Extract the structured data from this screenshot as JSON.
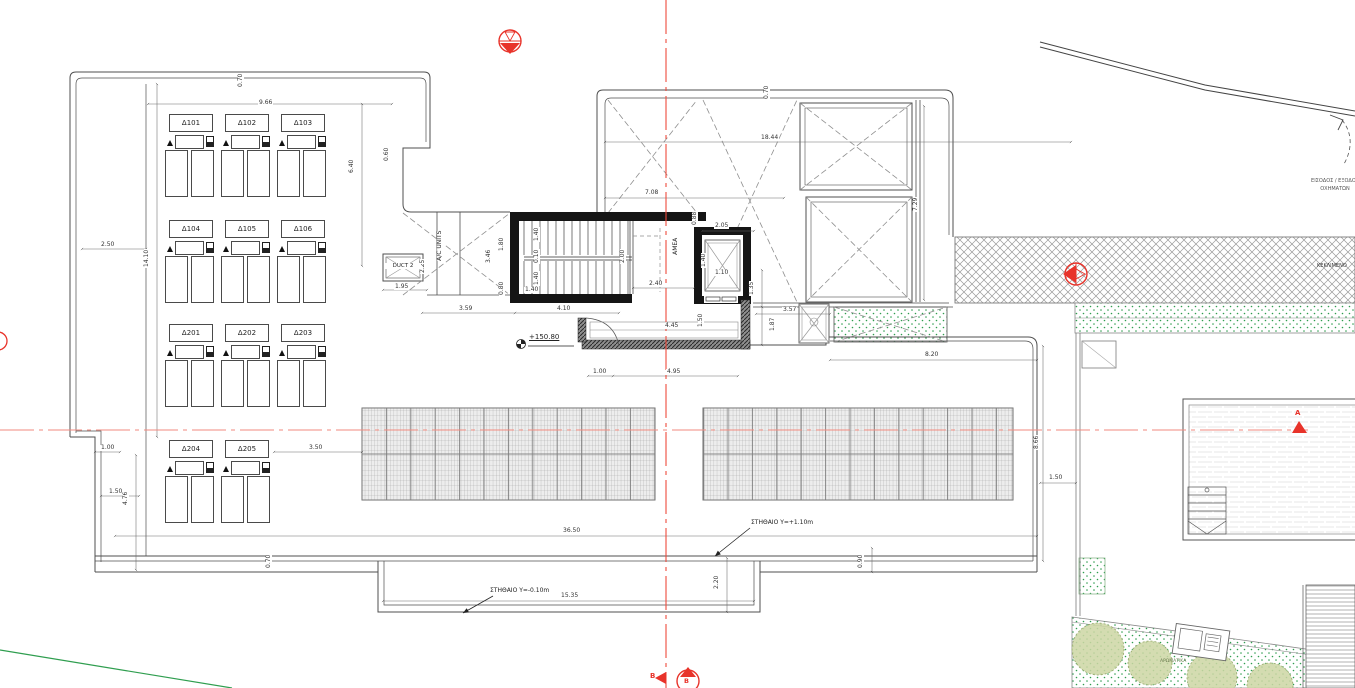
{
  "colors": {
    "line": "#4f4f4f",
    "wall": "#151515",
    "red_marker": "#e8332a",
    "centerline_v": "#ee4b3c",
    "centerline_h": "#f28a7f",
    "green": "#2f9e4f",
    "bush_fill": "#ccd6a3",
    "hatch": "#9a9a9a"
  },
  "ac_units": [
    {
      "label": "Δ101",
      "x": 165,
      "y": 114
    },
    {
      "label": "Δ102",
      "x": 221,
      "y": 114
    },
    {
      "label": "Δ103",
      "x": 277,
      "y": 114
    },
    {
      "label": "Δ104",
      "x": 165,
      "y": 220
    },
    {
      "label": "Δ105",
      "x": 221,
      "y": 220
    },
    {
      "label": "Δ106",
      "x": 277,
      "y": 220
    },
    {
      "label": "Δ201",
      "x": 165,
      "y": 324
    },
    {
      "label": "Δ202",
      "x": 221,
      "y": 324
    },
    {
      "label": "Δ203",
      "x": 277,
      "y": 324
    },
    {
      "label": "Δ204",
      "x": 165,
      "y": 440
    },
    {
      "label": "Δ205",
      "x": 221,
      "y": 440
    }
  ],
  "dimensions": [
    {
      "t": "0.70",
      "x": 244,
      "y": 82,
      "r": 1
    },
    {
      "t": "9.66",
      "x": 258,
      "y": 100
    },
    {
      "t": "2.50",
      "x": 100,
      "y": 242
    },
    {
      "t": "14.10",
      "x": 150,
      "y": 262,
      "r": 1
    },
    {
      "t": "6.40",
      "x": 355,
      "y": 168,
      "r": 1
    },
    {
      "t": "0.60",
      "x": 390,
      "y": 156,
      "r": 1
    },
    {
      "t": "1.00",
      "x": 100,
      "y": 445
    },
    {
      "t": "1.50",
      "x": 108,
      "y": 489
    },
    {
      "t": "4.76",
      "x": 129,
      "y": 500,
      "r": 1
    },
    {
      "t": "3.50",
      "x": 308,
      "y": 445
    },
    {
      "t": "1.95",
      "x": 394,
      "y": 284
    },
    {
      "t": "2.25",
      "x": 426,
      "y": 268,
      "r": 1
    },
    {
      "t": "3.46",
      "x": 492,
      "y": 258,
      "r": 1
    },
    {
      "t": "1.80",
      "x": 505,
      "y": 246,
      "r": 1
    },
    {
      "t": "0.80",
      "x": 505,
      "y": 290,
      "r": 1
    },
    {
      "t": "3.59",
      "x": 458,
      "y": 306
    },
    {
      "t": "4.10",
      "x": 556,
      "y": 306
    },
    {
      "t": "1.40",
      "x": 524,
      "y": 287
    },
    {
      "t": "1.40",
      "x": 540,
      "y": 236,
      "r": 1
    },
    {
      "t": "0.10",
      "x": 540,
      "y": 258,
      "r": 1
    },
    {
      "t": "1.40",
      "x": 540,
      "y": 280,
      "r": 1
    },
    {
      "t": "2.40",
      "x": 648,
      "y": 281
    },
    {
      "t": "2.00",
      "x": 626,
      "y": 258,
      "r": 1
    },
    {
      "t": "0.88",
      "x": 698,
      "y": 220,
      "r": 1
    },
    {
      "t": "2.05",
      "x": 714,
      "y": 223
    },
    {
      "t": "1.40",
      "x": 707,
      "y": 262,
      "r": 1
    },
    {
      "t": "1.10",
      "x": 714,
      "y": 270
    },
    {
      "t": "4.45",
      "x": 664,
      "y": 323
    },
    {
      "t": "1.50",
      "x": 704,
      "y": 322,
      "r": 1
    },
    {
      "t": "1.00",
      "x": 592,
      "y": 369
    },
    {
      "t": "4.95",
      "x": 666,
      "y": 369
    },
    {
      "t": "0.70",
      "x": 770,
      "y": 94,
      "r": 1
    },
    {
      "t": "18.44",
      "x": 760,
      "y": 135
    },
    {
      "t": "7.08",
      "x": 644,
      "y": 190
    },
    {
      "t": "7.29",
      "x": 919,
      "y": 206,
      "r": 1
    },
    {
      "t": "1.35",
      "x": 755,
      "y": 290,
      "r": 1
    },
    {
      "t": "3.57",
      "x": 782,
      "y": 307
    },
    {
      "t": "1.87",
      "x": 776,
      "y": 326,
      "r": 1
    },
    {
      "t": "8.20",
      "x": 924,
      "y": 352
    },
    {
      "t": "8.66",
      "x": 1040,
      "y": 444,
      "r": 1
    },
    {
      "t": "1.50",
      "x": 1048,
      "y": 475
    },
    {
      "t": "36.50",
      "x": 562,
      "y": 528
    },
    {
      "t": "15.35",
      "x": 560,
      "y": 593
    },
    {
      "t": "2.20",
      "x": 720,
      "y": 584,
      "r": 1
    },
    {
      "t": "0.90",
      "x": 864,
      "y": 563,
      "r": 1
    },
    {
      "t": "0.70",
      "x": 272,
      "y": 563,
      "r": 1
    }
  ],
  "labels": [
    {
      "t": "DUCT 2",
      "x": 385,
      "y": 263,
      "s": 5.5,
      "w": 36,
      "a": "center",
      "g": 1
    },
    {
      "t": "A/C UNITS",
      "x": 444,
      "y": 254,
      "s": 6,
      "r": 1,
      "g": 1
    },
    {
      "t": "AMEA",
      "x": 680,
      "y": 248,
      "s": 6,
      "r": 1,
      "g": 1
    },
    {
      "t": "+150.80",
      "x": 529,
      "y": 333,
      "s": 7,
      "u": 1
    },
    {
      "t": "ΣΤΗΘΑΙΟ Υ=+1.10m",
      "x": 751,
      "y": 520,
      "s": 6
    },
    {
      "t": "ΣΤΗΘΑΙΟ Υ=-0.10m",
      "x": 490,
      "y": 588,
      "s": 6
    },
    {
      "t": "ΕΙΣΟΔΟΣ / ΕΞΟΔΟΣ",
      "x": 1280,
      "y": 179,
      "s": 5,
      "c": "#555",
      "w": 110,
      "a": "center"
    },
    {
      "t": "ΟΧΗΜΑΤΩΝ",
      "x": 1280,
      "y": 187,
      "s": 5,
      "c": "#555",
      "w": 110,
      "a": "center"
    },
    {
      "t": "ΚΕΚΛΙΜΕΝΟ",
      "x": 1317,
      "y": 264,
      "s": 5,
      "c": "#333"
    },
    {
      "t": "ΑΡΩΜΑΤΙΚΑ",
      "x": 1160,
      "y": 659,
      "s": 4.5,
      "c": "#6b7c4f"
    },
    {
      "t": "B",
      "x": 650,
      "y": 672,
      "s": 7,
      "c": "#e8332a",
      "b": 1
    },
    {
      "t": "B",
      "x": 684,
      "y": 678,
      "s": 6.5,
      "c": "#e8332a",
      "b": 1
    },
    {
      "t": "A",
      "x": 1295,
      "y": 409,
      "s": 7,
      "c": "#e8332a",
      "b": 1
    }
  ]
}
